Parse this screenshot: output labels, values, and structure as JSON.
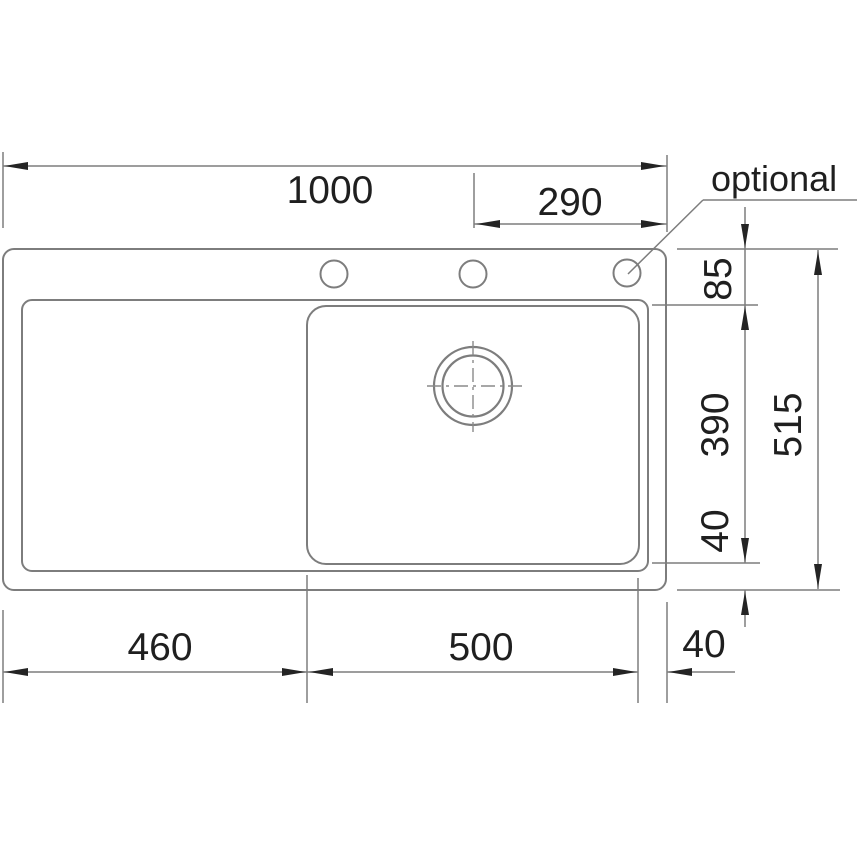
{
  "drawing": {
    "annotation": {
      "optional_label": "optional"
    },
    "dimensions": {
      "total_width": "1000",
      "tap_hole_to_right_edge": "290",
      "top_edge_to_bowl": "85",
      "bowl_length": "390",
      "bowl_to_bottom_edge": "40",
      "total_depth": "515",
      "drainer_width": "460",
      "bowl_width": "500",
      "bowl_to_right_edge": "40"
    },
    "colors": {
      "outline": "#7d7d7d",
      "dimension_line": "#7d7d7d",
      "arrow": "#242424",
      "text": "#1f1f1f",
      "background": "#ffffff"
    }
  }
}
